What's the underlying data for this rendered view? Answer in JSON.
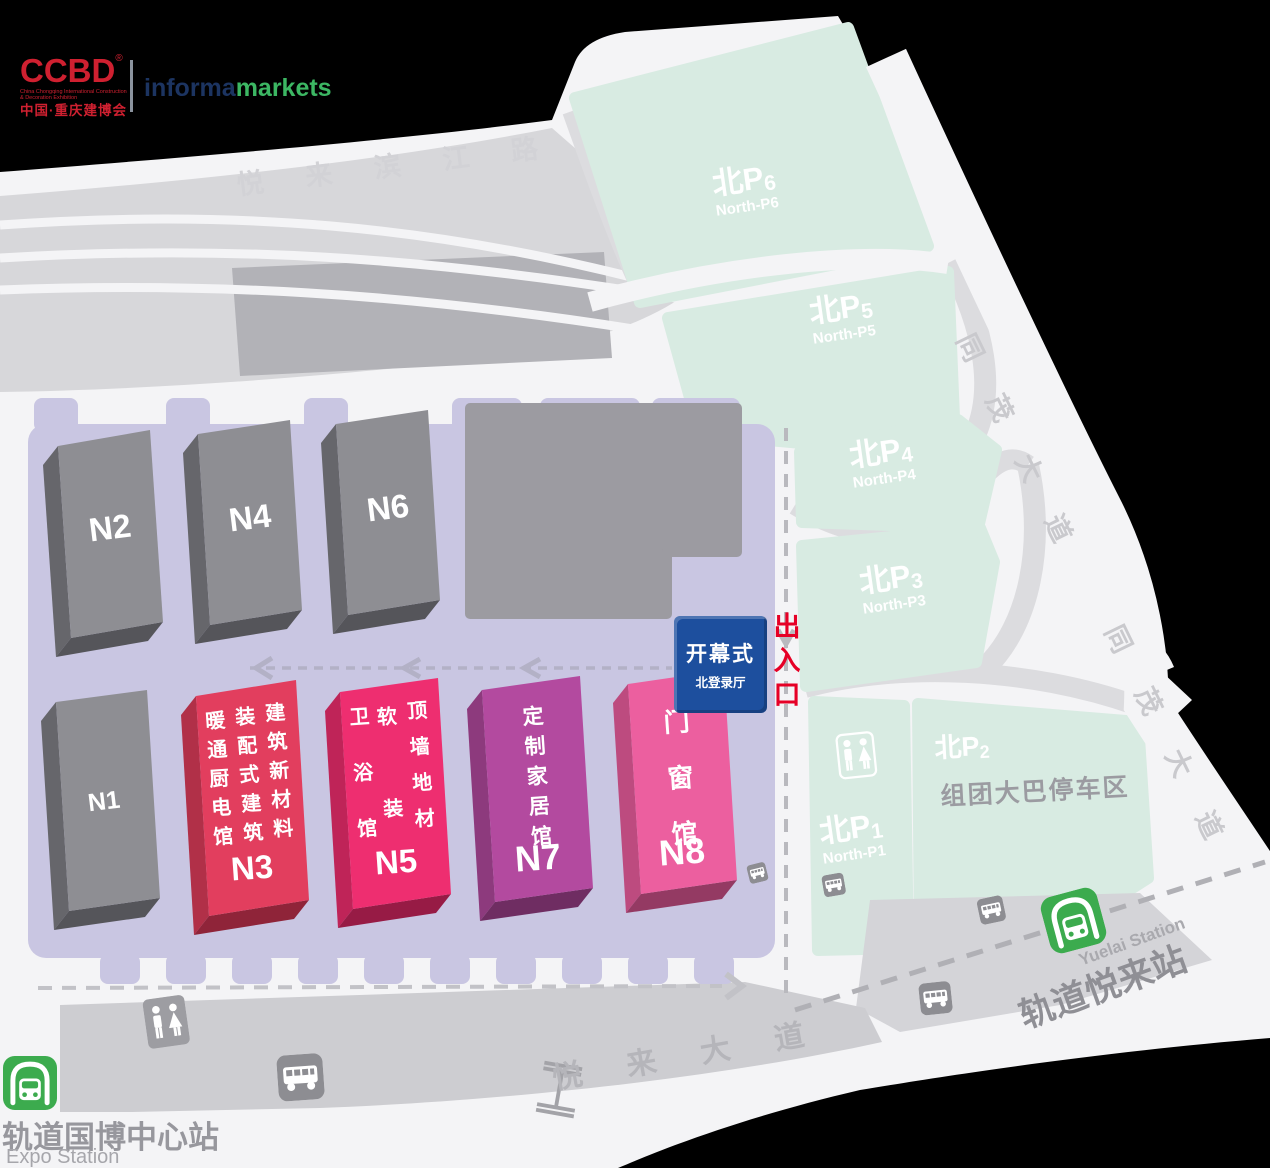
{
  "logo": {
    "ccbd": "CCBD",
    "reg": "®",
    "subtitle": "China Chongqing International Construction & Decoration Exhibition",
    "cn": "中国·重庆建博会",
    "informa": "informa",
    "markets": "markets"
  },
  "roads": {
    "top": "悦来滨江路",
    "right": "同茂大道",
    "bottom": "悦来大道"
  },
  "parking": {
    "p6": {
      "cn": "北P",
      "num": "6",
      "en": "North-P6"
    },
    "p5": {
      "cn": "北P",
      "num": "5",
      "en": "North-P5"
    },
    "p4": {
      "cn": "北P",
      "num": "4",
      "en": "North-P4"
    },
    "p3": {
      "cn": "北P",
      "num": "3",
      "en": "North-P3"
    },
    "p2": {
      "cn": "北P",
      "num": "2",
      "desc": "组团大巴停车区"
    },
    "p1": {
      "cn": "北P",
      "num": "1",
      "en": "North-P1"
    }
  },
  "halls": {
    "n1": {
      "label": "N1"
    },
    "n2": {
      "label": "N2"
    },
    "n4": {
      "label": "N4"
    },
    "n6": {
      "label": "N6"
    },
    "n3": {
      "label": "N3",
      "col1": "建筑新材料",
      "col2": "装配式建筑",
      "col3": "暖通厨电馆"
    },
    "n5": {
      "label": "N5",
      "col1": "顶墙地材",
      "col2": "软装",
      "col3": "卫浴馆"
    },
    "n7": {
      "label": "N7",
      "col1": "定制家居馆"
    },
    "n8": {
      "label": "N8",
      "col1": "门窗馆"
    }
  },
  "entrance": {
    "ceremony": "开幕式",
    "hall": "北登录厅",
    "gate": "出入口"
  },
  "stations": {
    "expo": {
      "cn": "轨道国博中心站",
      "en": "Expo Station"
    },
    "yuelai": {
      "cn": "轨道悦来站",
      "en": "Yuelai Station"
    }
  },
  "colors": {
    "background": "#000000",
    "map": "#f4f4f6",
    "parking_teal": "#d8ebe2",
    "expo_zone_purple": "#c9c6e2",
    "hall_gray": "#8e8e93",
    "hall_n3_red": "#e23e5e",
    "hall_n5_pink": "#ee2e70",
    "hall_n7_purple": "#b34a9f",
    "hall_n8_pink": "#ec5f9f",
    "ceremony_blue": "#1d4f9e",
    "gate_red": "#e60026",
    "metro_green": "#3cab4e",
    "ccbd_red": "#cf2030"
  }
}
